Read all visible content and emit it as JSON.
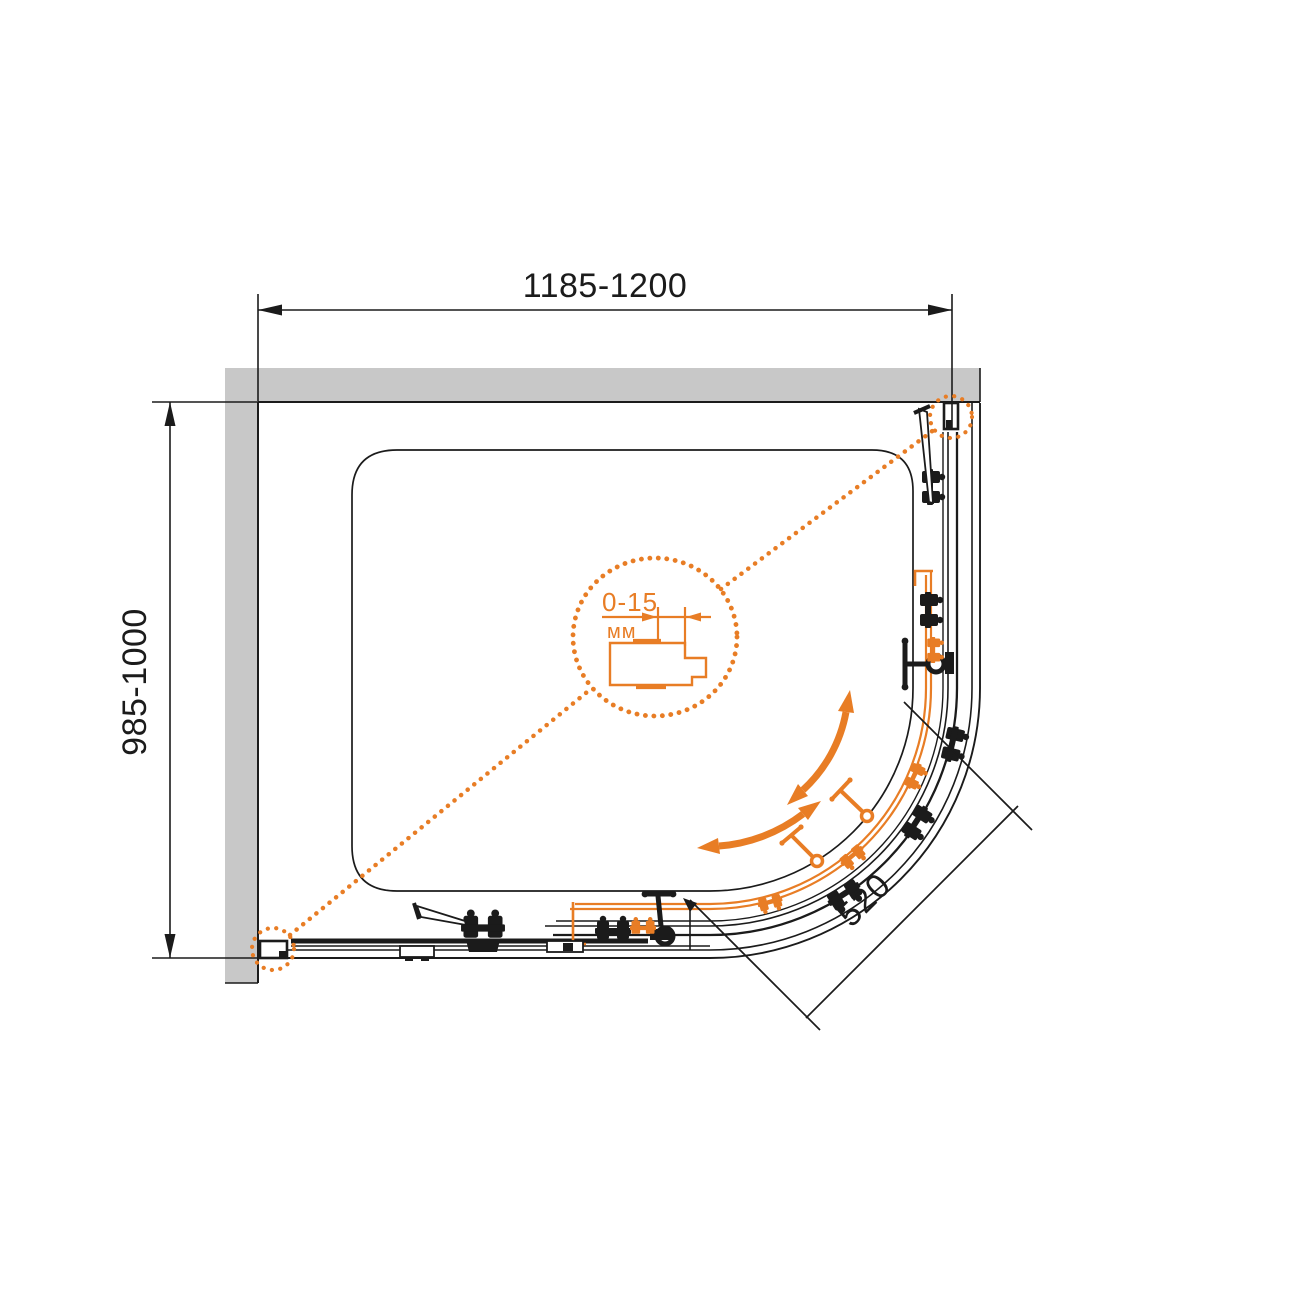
{
  "colors": {
    "ink": "#1B1B1B",
    "accent_orange": "#E87D25",
    "wall_gray": "#C8C8C8",
    "background": "#FFFFFF"
  },
  "dimensions": {
    "width_range": "1185-1200",
    "depth_range": "985-1000",
    "door_opening": "520",
    "adjustment_range": "0-15",
    "adjustment_unit": "мм"
  },
  "icons": {
    "detail_callout": "dotted-circle-magnifier",
    "slide_direction": "curved-double-arrow",
    "dimension_arrow": "filled-triangle"
  }
}
